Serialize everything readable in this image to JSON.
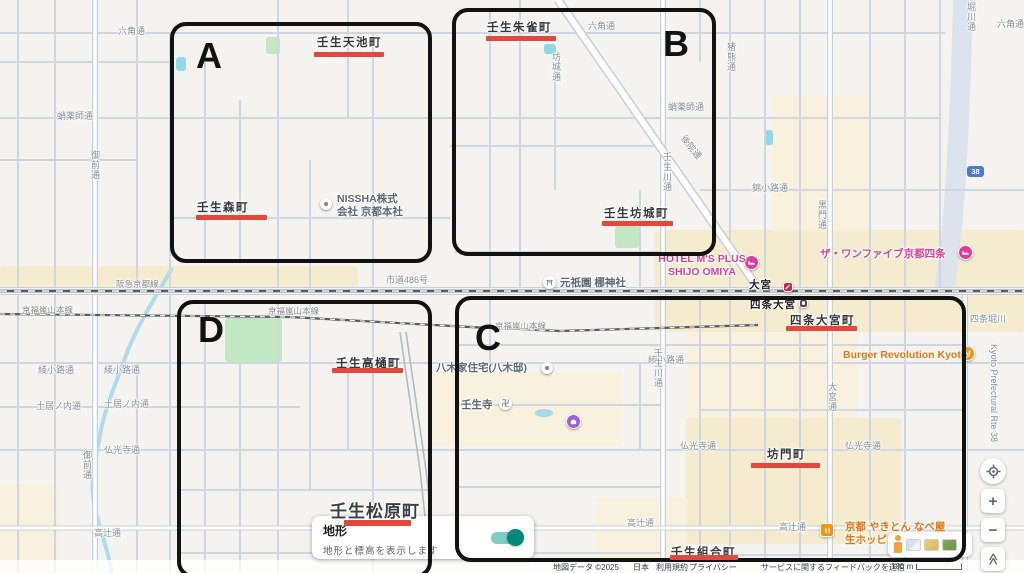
{
  "terrain_card": {
    "title": "地形",
    "subtitle": "地形と標高を表示します",
    "enabled": true
  },
  "controls": {
    "zoom_in": "+",
    "zoom_out": "−",
    "collapse": "≪"
  },
  "regions": [
    {
      "label": "A",
      "x": 170,
      "y": 22,
      "w": 262,
      "h": 241,
      "lx": 196,
      "ly": 38
    },
    {
      "label": "B",
      "x": 452,
      "y": 8,
      "w": 264,
      "h": 248,
      "lx": 663,
      "ly": 26
    },
    {
      "label": "C",
      "x": 455,
      "y": 296,
      "w": 511,
      "h": 266,
      "lx": 475,
      "ly": 320
    },
    {
      "label": "D",
      "x": 177,
      "y": 300,
      "w": 255,
      "h": 278,
      "lx": 198,
      "ly": 312
    }
  ],
  "marked_places": [
    {
      "name": "壬生天池町",
      "tx": 317,
      "ty": 34,
      "ux": 314,
      "uy": 52,
      "uw": 70
    },
    {
      "name": "壬生朱雀町",
      "tx": 487,
      "ty": 19,
      "ux": 486,
      "uy": 36,
      "uw": 70
    },
    {
      "name": "壬生森町",
      "tx": 197,
      "ty": 199,
      "ux": 196,
      "uy": 215,
      "uw": 71
    },
    {
      "name": "壬生坊城町",
      "tx": 604,
      "ty": 205,
      "ux": 602,
      "uy": 221,
      "uw": 71
    },
    {
      "name": "壬生高樋町",
      "tx": 336,
      "ty": 355,
      "ux": 332,
      "uy": 368,
      "uw": 71
    },
    {
      "name": "四条大宮町",
      "tx": 790,
      "ty": 312,
      "ux": 786,
      "uy": 326,
      "uw": 71
    },
    {
      "name": "坊門町",
      "tx": 767,
      "ty": 446,
      "ux": 751,
      "uy": 463,
      "uw": 69
    },
    {
      "name": "壬生松原町",
      "big": true,
      "tx": 330,
      "ty": 497,
      "ux": 344,
      "uy": 520,
      "uw": 67
    },
    {
      "name": "壬生組合町",
      "tx": 671,
      "ty": 544,
      "ux": 670,
      "uy": 555,
      "uw": 68
    }
  ],
  "map": {
    "road_labels": [
      {
        "text": "六角通",
        "x": 118,
        "y": 27
      },
      {
        "text": "六角通",
        "x": 588,
        "y": 22
      },
      {
        "text": "六角通",
        "x": 997,
        "y": 20
      },
      {
        "text": "蛸薬師通",
        "x": 57,
        "y": 112
      },
      {
        "text": "蛸薬師通",
        "x": 668,
        "y": 103
      },
      {
        "text": "錦小路通",
        "x": 752,
        "y": 184
      },
      {
        "text": "綾小路通",
        "x": 38,
        "y": 366
      },
      {
        "text": "綾小路通",
        "x": 104,
        "y": 366
      },
      {
        "text": "綾小路通",
        "x": 648,
        "y": 356
      },
      {
        "text": "土居ノ内通",
        "x": 36,
        "y": 402
      },
      {
        "text": "土居ノ内通",
        "x": 104,
        "y": 400
      },
      {
        "text": "仏光寺通",
        "x": 104,
        "y": 446
      },
      {
        "text": "仏光寺通",
        "x": 680,
        "y": 442
      },
      {
        "text": "仏光寺通",
        "x": 845,
        "y": 442
      },
      {
        "text": "高辻通",
        "x": 94,
        "y": 529
      },
      {
        "text": "高辻通",
        "x": 627,
        "y": 519
      },
      {
        "text": "高辻通",
        "x": 779,
        "y": 523
      },
      {
        "text": "市道486号",
        "x": 386,
        "y": 276
      },
      {
        "text": "御前通",
        "x": 90,
        "y": 150,
        "vert": true
      },
      {
        "text": "御前通",
        "x": 82,
        "y": 450,
        "vert": true
      },
      {
        "text": "壬生川通",
        "x": 662,
        "y": 152,
        "vert": true
      },
      {
        "text": "壬生川通",
        "x": 653,
        "y": 348,
        "vert": true
      },
      {
        "text": "大宮通",
        "x": 827,
        "y": 382,
        "vert": true
      },
      {
        "text": "坊城通",
        "x": 551,
        "y": 52,
        "vert": true
      },
      {
        "text": "猪熊通",
        "x": 726,
        "y": 42,
        "vert": true
      },
      {
        "text": "黒門通",
        "x": 817,
        "y": 200,
        "vert": true
      },
      {
        "text": "堀川通",
        "x": 966,
        "y": 2,
        "vert": true
      },
      {
        "text": "四条堀川",
        "x": 970,
        "y": 315
      },
      {
        "text": "後院通",
        "x": 686,
        "y": 134,
        "rot": 52
      },
      {
        "text": "Kyoto Prefectural Rte 38",
        "x": 998,
        "y": 344,
        "rot": 90
      },
      {
        "text": "阪急京都線",
        "x": 116,
        "y": 280,
        "cls": "rail"
      },
      {
        "text": "京福嵐山本線",
        "x": 22,
        "y": 306,
        "cls": "rail"
      },
      {
        "text": "京福嵐山本線",
        "x": 268,
        "y": 307,
        "cls": "rail"
      },
      {
        "text": "京福嵐山本線",
        "x": 495,
        "y": 322,
        "cls": "rail"
      },
      {
        "text": "大宮",
        "x": 749,
        "y": 280,
        "cls": "sta"
      },
      {
        "text": "四条大宮",
        "x": 750,
        "y": 300,
        "cls": "sta"
      }
    ],
    "pois": [
      {
        "type": "pin",
        "icon_x": 320,
        "icon_y": 198,
        "label": "NISSHA株式\n会社 京都本社",
        "lx": 337,
        "ly": 193,
        "lcls": "gray"
      },
      {
        "type": "pin",
        "icon_x": 541,
        "icon_y": 362,
        "label": "八木家住宅(八木邸)",
        "lx": 436,
        "ly": 362,
        "lcls": "gray"
      },
      {
        "type": "shrine",
        "icon_x": 543,
        "icon_y": 276,
        "label": "元祇園 梛神社",
        "lx": 560,
        "ly": 277,
        "lcls": "gray"
      },
      {
        "type": "manji",
        "icon_x": 499,
        "icon_y": 397,
        "label": "壬生寺",
        "lx": 461,
        "ly": 399,
        "lcls": "gray"
      },
      {
        "type": "museum",
        "icon_x": 566,
        "icon_y": 414,
        "label": ""
      },
      {
        "type": "hotel",
        "icon_x": 744,
        "icon_y": 255,
        "label": "HOTEL M'S PLUS\nSHIJO OMIYA",
        "lx": 656,
        "ly": 253,
        "lcls": "pink",
        "center": true
      },
      {
        "type": "hotel",
        "icon_x": 958,
        "icon_y": 245,
        "label": "ザ・ワンファイブ京都四条",
        "lx": 820,
        "ly": 248,
        "lcls": "pink"
      },
      {
        "type": "food",
        "icon_x": 960,
        "icon_y": 346,
        "label": "Burger Revolution Kyoto",
        "lx": 843,
        "ly": 349,
        "lcls": "orange"
      },
      {
        "type": "food_sq",
        "icon_x": 820,
        "icon_y": 523,
        "label": "京都 やきとん なべ屋\n生ホッピー",
        "lx": 845,
        "ly": 521,
        "lcls": "orange"
      },
      {
        "type": "station_red",
        "icon_x": 783,
        "icon_y": 282,
        "label": ""
      },
      {
        "type": "tram",
        "icon_x": 799,
        "icon_y": 299,
        "label": ""
      },
      {
        "type": "shield",
        "icon_x": 967,
        "icon_y": 166,
        "label": "38"
      }
    ]
  },
  "attribution": {
    "items": [
      {
        "text": "地図データ ©2025",
        "x": 553,
        "link": false
      },
      {
        "text": "日本",
        "x": 633,
        "link": false
      },
      {
        "text": "利用規約",
        "x": 656,
        "link": true
      },
      {
        "text": "プライバシー",
        "x": 689,
        "link": true
      },
      {
        "text": "サービスに関するフィードバックを送信",
        "x": 761,
        "link": true
      },
      {
        "text": "100 m",
        "x": 891,
        "link": false
      }
    ]
  }
}
